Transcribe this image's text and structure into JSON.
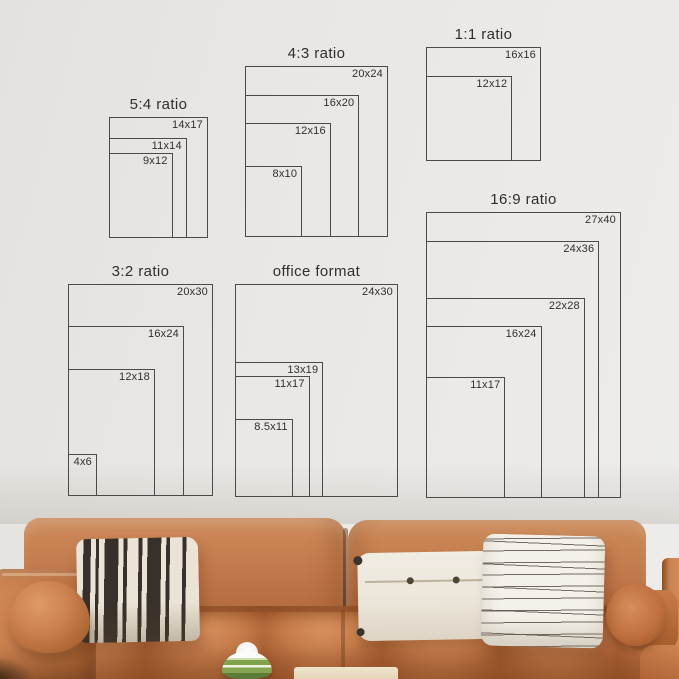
{
  "scene": {
    "colors": {
      "wall": "#eae8e5",
      "wall-dark": "#e4e2df",
      "line": "#4a4a4a",
      "text": "#2f2f2f",
      "couch": "#c0774a",
      "couch-light": "#d68f5e",
      "couch-dark": "#9a5a2c",
      "cream": "#ebe4d6",
      "stripe-dark": "#38302a",
      "white-pillow": "#f1ece2",
      "green": "#7fa24a",
      "table": "#f0e5cd"
    }
  },
  "diagrams": [
    {
      "id": "ratio-5-4",
      "title": "5:4 ratio",
      "sizes": [
        {
          "label": "14x17",
          "w": 14,
          "h": 17
        },
        {
          "label": "11x14",
          "w": 11,
          "h": 14
        },
        {
          "label": "9x12",
          "w": 9,
          "h": 12
        }
      ]
    },
    {
      "id": "ratio-4-3",
      "title": "4:3 ratio",
      "sizes": [
        {
          "label": "20x24",
          "w": 20,
          "h": 24
        },
        {
          "label": "16x20",
          "w": 16,
          "h": 20
        },
        {
          "label": "12x16",
          "w": 12,
          "h": 16
        },
        {
          "label": "8x10",
          "w": 8,
          "h": 10
        }
      ]
    },
    {
      "id": "ratio-1-1",
      "title": "1:1 ratio",
      "sizes": [
        {
          "label": "16x16",
          "w": 16,
          "h": 16
        },
        {
          "label": "12x12",
          "w": 12,
          "h": 12
        }
      ]
    },
    {
      "id": "ratio-3-2",
      "title": "3:2 ratio",
      "sizes": [
        {
          "label": "20x30",
          "w": 20,
          "h": 30
        },
        {
          "label": "16x24",
          "w": 16,
          "h": 24
        },
        {
          "label": "12x18",
          "w": 12,
          "h": 18
        },
        {
          "label": "4x6",
          "w": 4,
          "h": 6
        }
      ]
    },
    {
      "id": "office-format",
      "title": "office format",
      "sizes": [
        {
          "label": "24x30",
          "w": 24,
          "h": 30
        },
        {
          "label": "13x19",
          "w": 13,
          "h": 19
        },
        {
          "label": "11x17",
          "w": 11,
          "h": 17
        },
        {
          "label": "8.5x11",
          "w": 8.5,
          "h": 11
        }
      ]
    },
    {
      "id": "ratio-16-9",
      "title": "16:9 ratio",
      "sizes": [
        {
          "label": "27x40",
          "w": 27,
          "h": 40
        },
        {
          "label": "24x36",
          "w": 24,
          "h": 36
        },
        {
          "label": "22x28",
          "w": 22,
          "h": 28
        },
        {
          "label": "16x24",
          "w": 16,
          "h": 24
        },
        {
          "label": "11x17",
          "w": 11,
          "h": 17
        }
      ]
    }
  ]
}
